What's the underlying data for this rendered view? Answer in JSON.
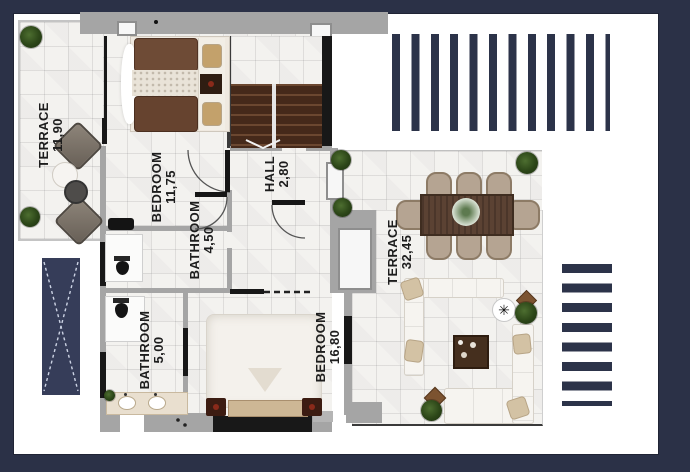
{
  "plan_title": "villa-upper-floor-plan",
  "rooms": {
    "terrace_small": {
      "label": "TERRACE",
      "area": "11,90"
    },
    "bedroom_top": {
      "label": "BEDROOM",
      "area": "11,75"
    },
    "bathroom_small": {
      "label": "BATHROOM",
      "area": "4,50"
    },
    "hall": {
      "label": "HALL",
      "area": "2,80"
    },
    "terrace_large": {
      "label": "TERRACE",
      "area": "32,45"
    },
    "bathroom_large": {
      "label": "BATHROOM",
      "area": "5,00"
    },
    "bedroom_bottom": {
      "label": "BEDROOM",
      "area": "16,80"
    }
  },
  "colors": {
    "navy_bg": "#2b3147",
    "navy_stripe": "#2c3349",
    "wall_gray": "#a5a5a5",
    "floor_tile": "#f3f2ef",
    "wood_stairs": "#45291a",
    "bed_brown": "#6e4b36",
    "plant_green": "#2c4618"
  }
}
